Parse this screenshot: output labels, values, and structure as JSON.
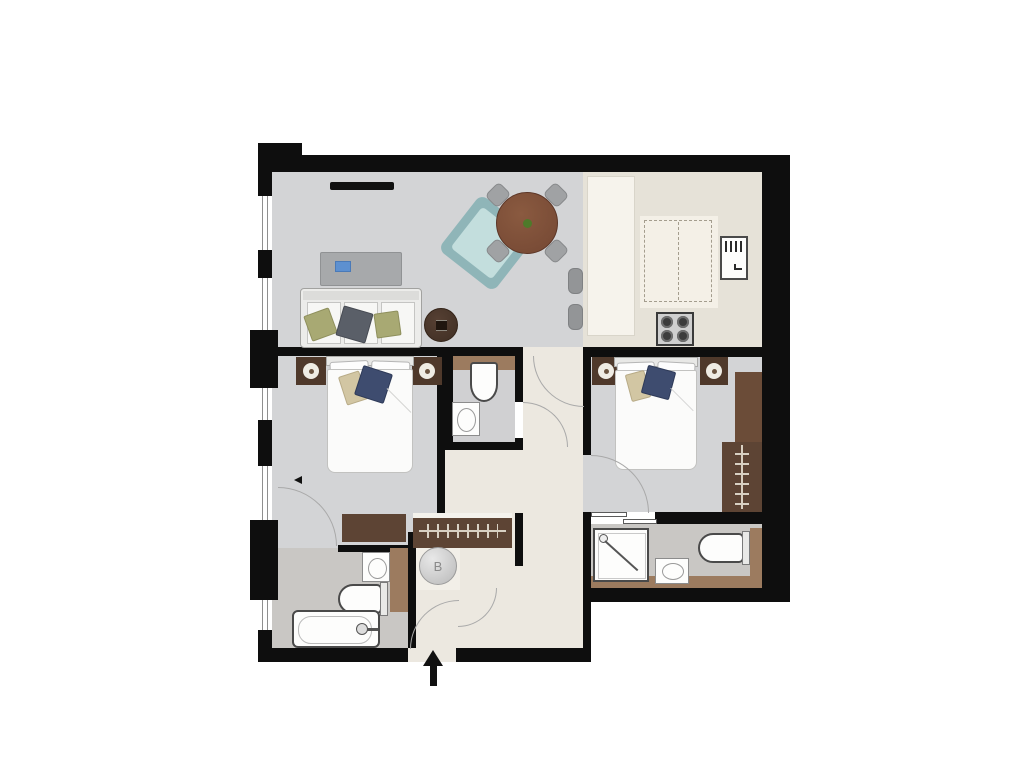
{
  "boiler": {
    "label": "B"
  },
  "entrance": {
    "symbol": "arrow-up"
  },
  "colors": {
    "wall": "#0e0e0e",
    "carpet": "#d3d4d6",
    "hall_floor": "#ece8e0",
    "kitchen_floor": "#e6e2d8",
    "tile_floor": "#c9c7c4",
    "counter": "#f6f3ec",
    "wood_dark": "#5d4434",
    "wood_night": "#4f392b",
    "vanity": "#9c7b5f",
    "table_wood": "#744733",
    "plant_green": "#4e7a2a",
    "teal_chair": "#c3dedd",
    "teal_chair_frame": "#8fb5b8",
    "cushion_olive": "#a8a973",
    "cushion_slate": "#5a5f68",
    "cushion_navy": "#3e4c6f",
    "cushion_tan": "#d2c6a3",
    "accent_blue": "#5d90d0",
    "arc": "#a9a9a9"
  },
  "rooms": {
    "living_room": {
      "fixtures": [
        "tv",
        "armchair",
        "dining-table",
        "dining-chairs",
        "coffee-table",
        "sofa",
        "side-table"
      ],
      "dining_chair_count": 4
    },
    "kitchen": {
      "fixtures": [
        "counter",
        "island-unit",
        "fridge",
        "hob",
        "bar-stools"
      ],
      "hob_burner_count": 4,
      "stool_count": 2
    },
    "bedroom_1": {
      "fixtures": [
        "double-bed",
        "nightstands",
        "lamps",
        "chest-of-drawers",
        "wardrobe-rail"
      ],
      "nightstand_count": 2
    },
    "bathroom_1": {
      "fixtures": [
        "bathtub",
        "toilet",
        "basin",
        "vanity-counter"
      ]
    },
    "wc": {
      "fixtures": [
        "toilet",
        "basin",
        "vanity-counter"
      ]
    },
    "bedroom_2": {
      "fixtures": [
        "double-bed",
        "nightstands",
        "lamps",
        "wardrobe-unit",
        "wardrobe-rail"
      ],
      "nightstand_count": 2
    },
    "ensuite_2": {
      "fixtures": [
        "shower",
        "basin",
        "toilet",
        "vanity-counter"
      ]
    },
    "hall": {
      "fixtures": [
        "boiler-cupboard",
        "entrance-door"
      ]
    }
  }
}
